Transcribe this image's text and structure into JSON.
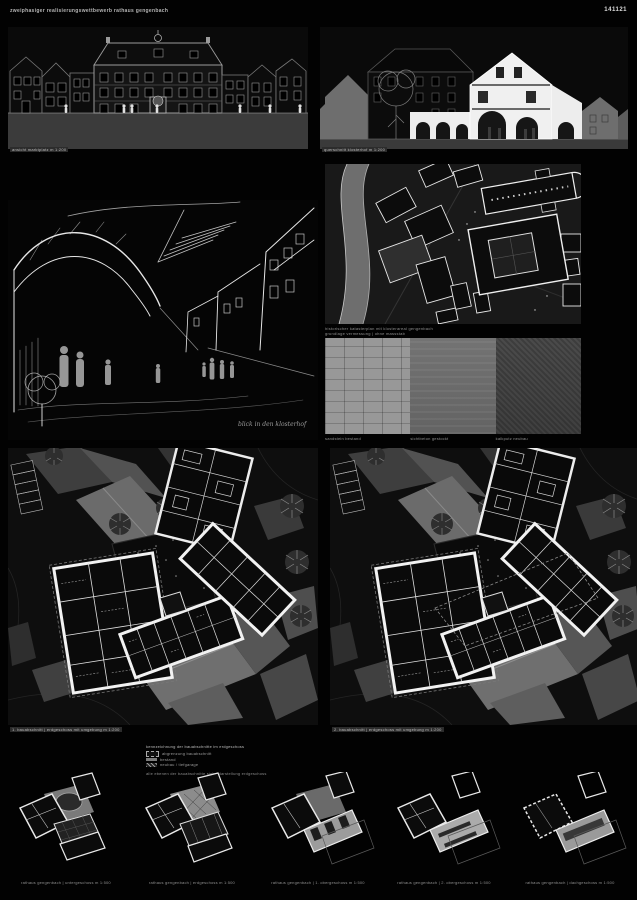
{
  "header": {
    "title": "zweiphasiger realisierungswettbewerb rathaus gengenbach",
    "code": "141121"
  },
  "panels": {
    "elevation": {
      "caption": "ansicht marktplatz m 1:200"
    },
    "section": {
      "caption": "querschnitt klosterhof m 1:200"
    },
    "sketch": {
      "signature": "blick in den klosterhof"
    },
    "siteplan": {
      "caption_line1": "historischer katasterplan mit klosterareal gengenbach",
      "caption_line2": "grundlage vermessung | ohne massstab"
    },
    "materials": {
      "items": [
        {
          "label": "sandstein bestand"
        },
        {
          "label": "sichtbeton gestockt"
        },
        {
          "label": "kalkputz neubau"
        }
      ]
    },
    "plan_first": {
      "caption": "1. bauabschnitt | erdgeschoss mit umgebung m 1:200"
    },
    "plan_second": {
      "caption": "2. bauabschnitt | erdgeschoss mit umgebung m 1:200"
    },
    "legend": {
      "title": "kennzeichnung der bauabschnitte im erdgeschoss",
      "items": [
        {
          "label": "abgrenzung bauabschnitt"
        },
        {
          "label": "bestand"
        },
        {
          "label": "neubau / tiefgarage"
        }
      ],
      "footnote": "alle ebenen der bauabschnitte siehe darstellung erdgeschoss"
    },
    "floorplans": [
      {
        "caption": "rathaus gengenbach | untergeschoss m 1:500"
      },
      {
        "caption": "rathaus gengenbach | erdgeschoss m 1:500"
      },
      {
        "caption": "rathaus gengenbach | 1. obergeschoss m 1:500"
      },
      {
        "caption": "rathaus gengenbach | 2. obergeschoss m 1:500"
      },
      {
        "caption": "rathaus gengenbach | dachgeschoss m 1:500"
      }
    ]
  },
  "colors": {
    "board_bg": "#020202",
    "panel_bg": "#0a0a0a",
    "ground_gray": "#3d3d3d",
    "silhouette_gray": "#6e6e6e",
    "line_gray": "#9a9a9a",
    "cut_white": "#f0f0f0"
  }
}
